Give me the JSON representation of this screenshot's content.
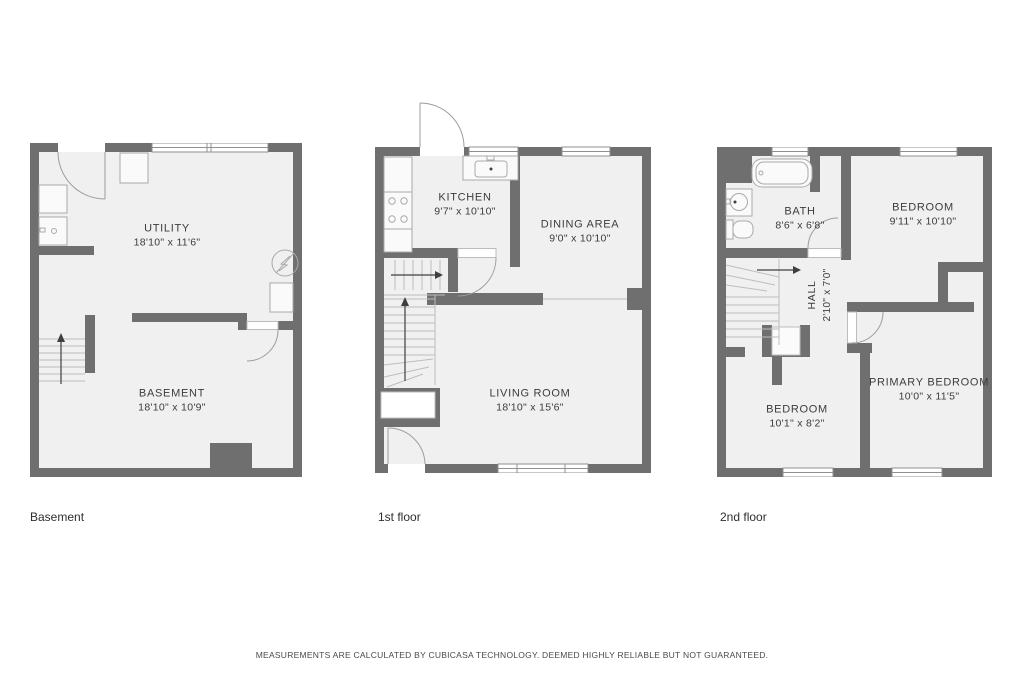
{
  "colors": {
    "wall": "#6f6f6f",
    "floor_fill": "#f0f0f0",
    "fixture_stroke": "#a9a9a9",
    "label_text": "#3c3c3c"
  },
  "floors": [
    {
      "id": "basement",
      "label": "Basement",
      "rooms": [
        {
          "name": "UTILITY",
          "dims": "18'10\" x 11'6\""
        },
        {
          "name": "BASEMENT",
          "dims": "18'10\" x 10'9\""
        }
      ]
    },
    {
      "id": "first",
      "label": "1st floor",
      "rooms": [
        {
          "name": "KITCHEN",
          "dims": "9'7\" x 10'10\""
        },
        {
          "name": "DINING AREA",
          "dims": "9'0\" x 10'10\""
        },
        {
          "name": "LIVING ROOM",
          "dims": "18'10\" x 15'6\""
        }
      ]
    },
    {
      "id": "second",
      "label": "2nd floor",
      "rooms": [
        {
          "name": "BATH",
          "dims": "8'6\" x 6'8\""
        },
        {
          "name": "BEDROOM",
          "dims": "9'11\" x 10'10\""
        },
        {
          "name": "HALL",
          "dims": "2'10\" x 7'0\""
        },
        {
          "name": "BEDROOM",
          "dims": "10'1\" x 8'2\""
        },
        {
          "name": "PRIMARY BEDROOM",
          "dims": "10'0\" x 11'5\""
        }
      ]
    }
  ],
  "footer": {
    "disclaimer": "MEASUREMENTS ARE CALCULATED BY CUBICASA TECHNOLOGY. DEEMED HIGHLY RELIABLE BUT NOT GUARANTEED."
  }
}
